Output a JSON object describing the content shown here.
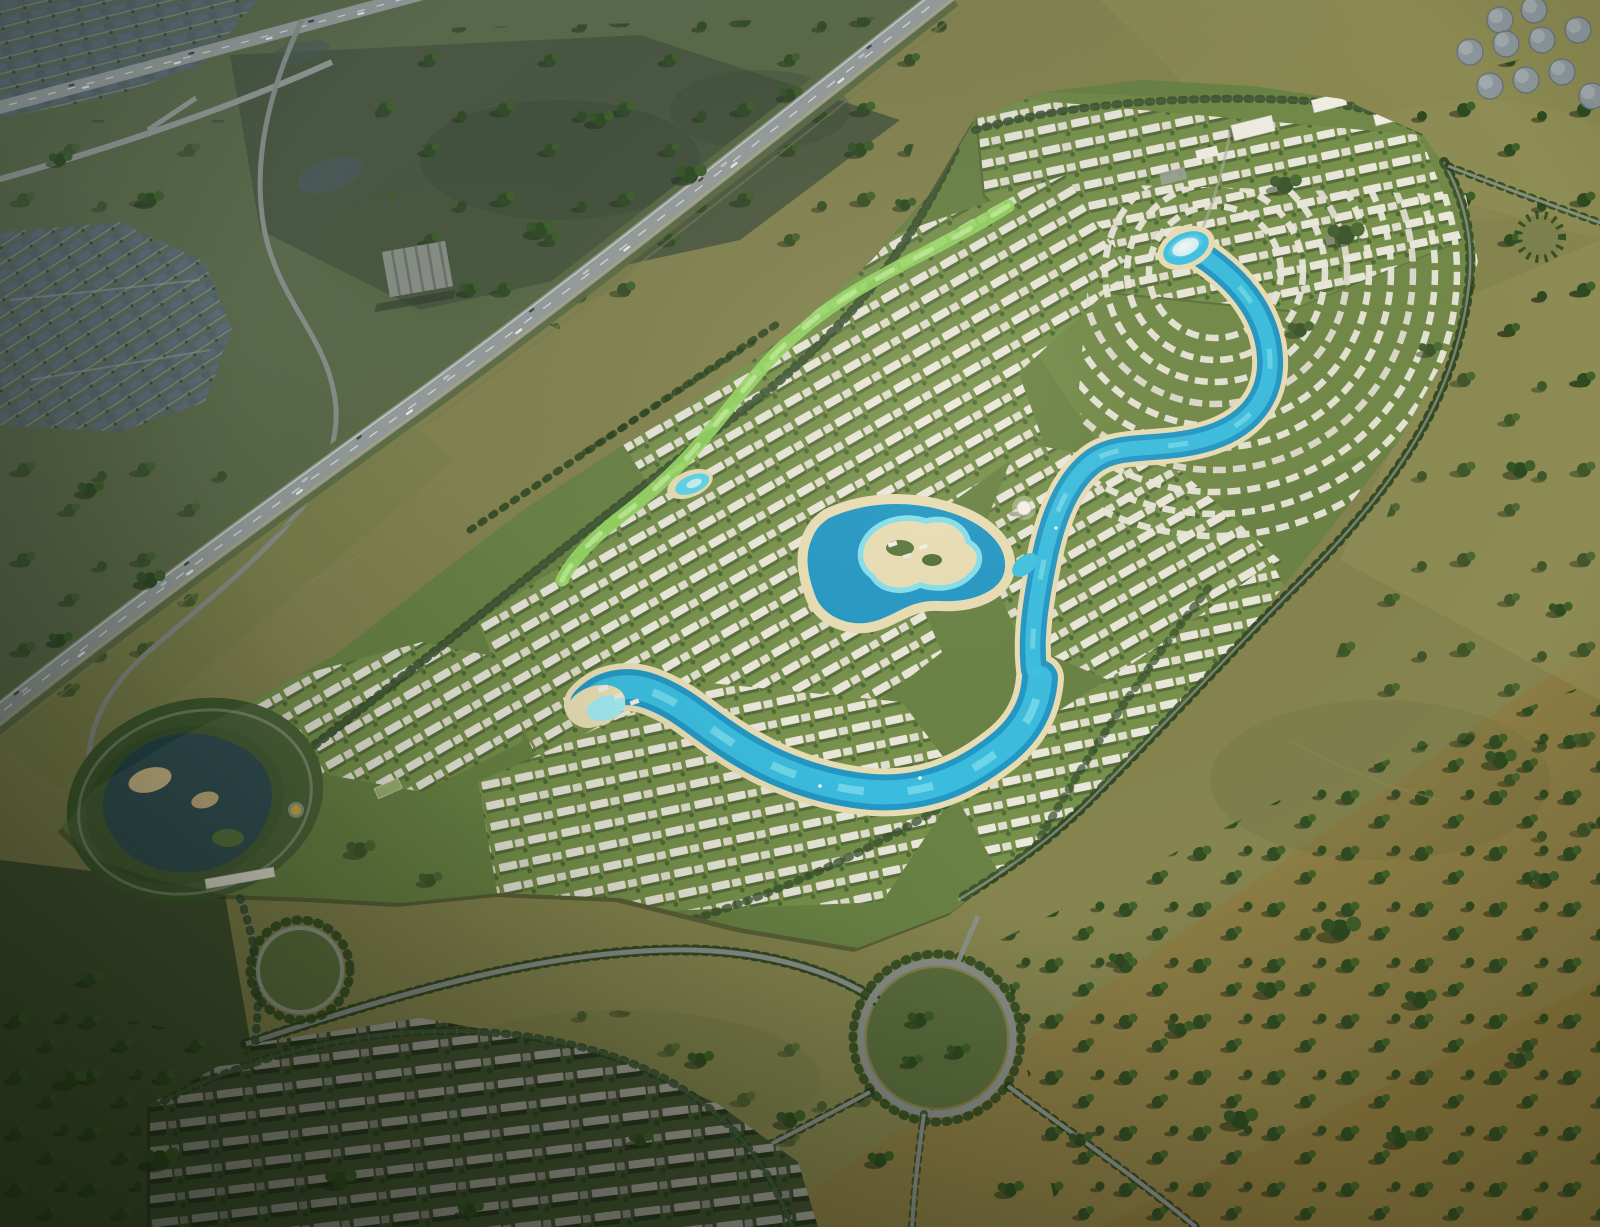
{
  "scene": {
    "type": "aerial-3d-render",
    "subject": "master-planned lagoon villa community surrounded by grassland, highways at top-left, storage tanks at top-right, second neighborhood under construction at bottom-left",
    "lighting": "low warm sun from upper right, long tree shadows toward lower left"
  },
  "colors": {
    "field_base": "#86854f",
    "field_cool": "#5d6b48",
    "field_dark": "#42522f",
    "field_tan": "#8e7c42",
    "wetland": "#46543d",
    "dev_green": "#5e7a38",
    "dev_green_light": "#6d8a40",
    "tree_dark": "#2e4a20",
    "tree_mid": "#3f6028",
    "tree_shadow": "#1b2712",
    "street_tree": "#24401c",
    "villa_white": "#eceadf",
    "villa_cream": "#e2dfd2",
    "row_shadow": "#2c421e",
    "suburb_base": "#5b6a5e",
    "roof_blue": "#5e6d7d",
    "roof_blue_dark": "#55636f",
    "suburb_street": "#98a0a0",
    "constr_base": "#415231",
    "constr_slab": "#a3a199",
    "constr_slab_dark": "#8f8d85",
    "road_gray": "#9ba19f",
    "road_local": "#8d918c",
    "lane_white": "#e8eae6",
    "verge_green": "#5e6e44",
    "lagoon_deep": "#1192c6",
    "lagoon_mid": "#2fc0e6",
    "lagoon_bright": "#8feef8",
    "lagoon_pale": "#c8f3f8",
    "sand": "#eadfb4",
    "beach_tan": "#d9c08a",
    "pond_dark": "#20424a",
    "park_green": "#3f5a2c",
    "corridor_green": "#8fdc5a",
    "gold": "#d8a93c",
    "dome_white": "#f8f6ee",
    "building_white": "#f2f0e8",
    "tank_gray": "#8d99a4",
    "tank_rim": "#6a7278",
    "glint": "#eafbff"
  }
}
